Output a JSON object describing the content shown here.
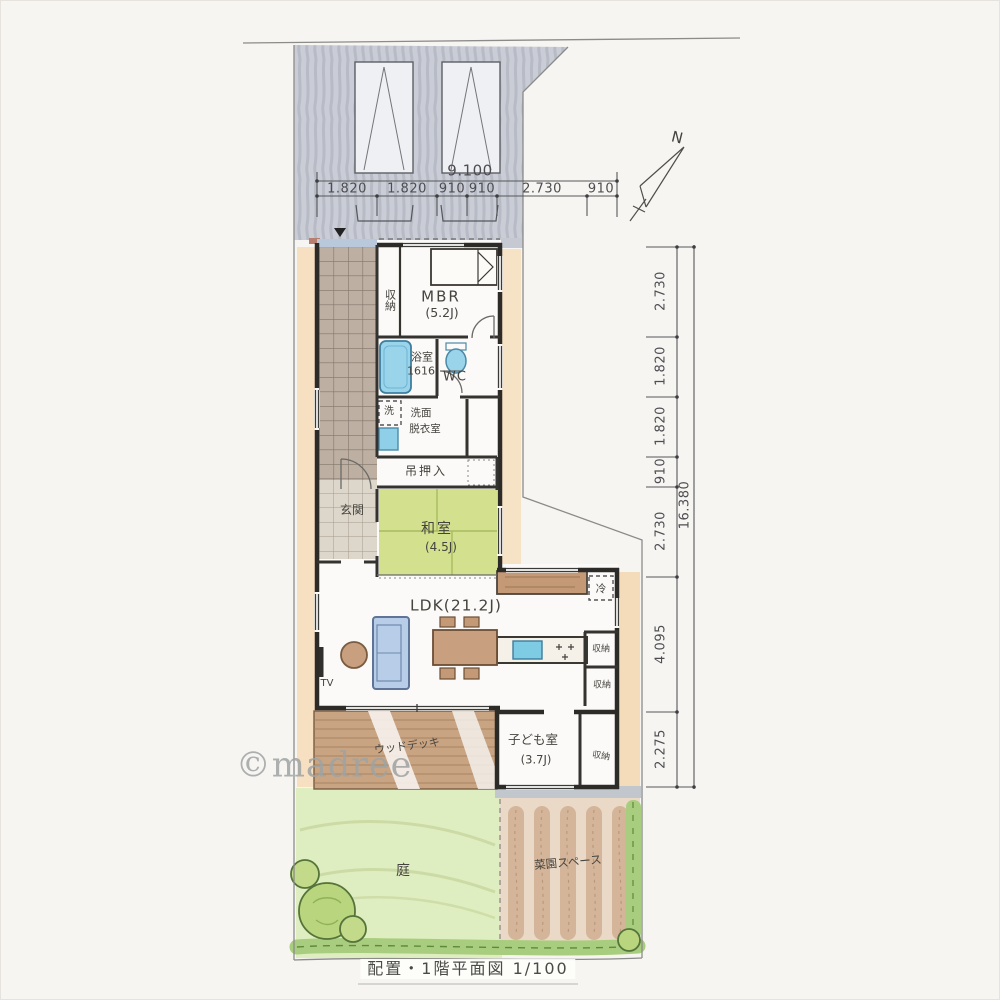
{
  "caption": "配置・1階平面図 1/100",
  "watermark": "©madree",
  "compass": {
    "label": "N"
  },
  "dim_top": {
    "total": "9.100",
    "segments": [
      "1.820",
      "1.820",
      "910",
      "910",
      "2.730",
      "910"
    ]
  },
  "dim_right": {
    "total": "16.380",
    "segments": [
      "2.730",
      "1.820",
      "1.820",
      "910",
      "2.730",
      "4.095",
      "2.275"
    ]
  },
  "rooms": {
    "mbr": {
      "name": "MBR",
      "size": "(5.2J)"
    },
    "mbr_closet": "収納",
    "bath": {
      "name": "浴室",
      "size": "1616"
    },
    "wc": "WC",
    "laundry": "洗",
    "washroom": {
      "line1": "洗面",
      "line2": "脱衣室"
    },
    "oshiire": "吊押入",
    "genkan": "玄関",
    "washitsu": {
      "name": "和室",
      "size": "(4.5J)"
    },
    "ldk": "LDK(21.2J)",
    "kids": {
      "name": "子ども室",
      "size": "(3.7J)"
    },
    "kids_closet": "収納",
    "storage_a": "収納",
    "storage_b": "収納",
    "deck": "ウッドデッキ",
    "garden": "庭",
    "veggie": "菜園スペース"
  },
  "fixtures": {
    "tv": "TV",
    "fridge": "冷"
  },
  "colors": {
    "tatami_green": "#d3e18f",
    "water_blue": "#9ad4ea",
    "lawn_green": "#dfeec0",
    "hedge_green": "#9cc46d",
    "soil_brown": "#cdaa8a",
    "deck_brown": "#c9a483",
    "parking_gray": "#cacdd6",
    "earth_orange": "#f6debc",
    "wall_black": "#2d2b28"
  }
}
